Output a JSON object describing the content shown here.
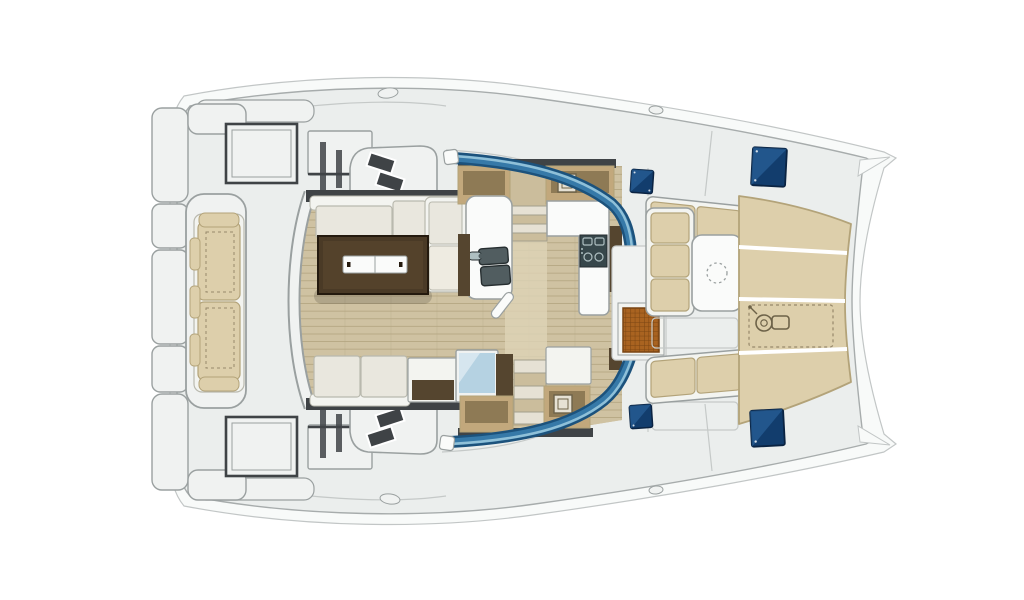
{
  "diagram": {
    "kind": "catamaran-deck-floor-plan",
    "view": "top-down",
    "text_labels": [],
    "parts": [
      "hull-deck",
      "bow-tips",
      "aft-platform",
      "aft-bench",
      "transom-step-panels",
      "deck-hatch-port",
      "deck-hatch-starboard",
      "side-deck-steps-port",
      "side-deck-steps-starboard",
      "saloon-floor",
      "saloon-sofa",
      "dining-table",
      "table-centerpiece",
      "galley-sink",
      "galley-stove",
      "galley-counter",
      "fridge-unit",
      "companionway-stairs-port",
      "companionway-stairs-starboard",
      "storage-lockers",
      "windshield-glass",
      "cockpit-settee",
      "cockpit-table",
      "cockpit-bench",
      "bow-sunpads",
      "windlass-locker",
      "teak-grate",
      "skylight-hatches",
      "cleats"
    ]
  },
  "icons": {
    "windlass-icon": "winch/gypsy glyph",
    "hatch-icon": "▣",
    "parasol-socket-icon": "◌ dashed circle",
    "stove-burner-icon": "○○",
    "sink-basin-icon": "▢▢"
  },
  "colors": {
    "page_bg": "#ffffff",
    "hull_outer": "#f8faf9",
    "hull_stroke": "#c2c6c6",
    "deck": "#ebeeed",
    "deck_stroke": "#a7acac",
    "seam": "#c5c9c8",
    "seam_dark": "#3f4346",
    "panel_fill": "#f0f2f1",
    "panel_stroke": "#9aa0a0",
    "panel_stroke_soft": "#c6cac9",
    "wood": "#cfc2a2",
    "wood_line": "#b3a581",
    "wood_light": "#ddd3b6",
    "wall_dark": "#3f4346",
    "wall_brown": "#55452f",
    "glass_dark": "#1c527c",
    "glass_mid": "#3679a8",
    "glass_light": "#8fc0d8",
    "navy": "#123d6d",
    "navy_light": "#2f6ba6",
    "navy_stroke": "#0a2342",
    "sofa_frame": "#f3f4f0",
    "cushion_white": "#e9e7de",
    "cushion_white2": "#eeebe1",
    "cushion_stroke": "#b9b9ae",
    "tan": "#ddcfab",
    "tan_stroke": "#b3a379",
    "tan_dash": "#97896b",
    "locker_tan": "#c2a87c",
    "locker_inner": "#8e7a55",
    "table_dark": "#4a3a26",
    "table_edge": "#241a0e",
    "table_mid": "#5d4930",
    "white": "#fafbfa",
    "steel": "#515d60",
    "steel_stroke": "#262e30",
    "teak": "#a96320",
    "teak_line": "#7a4512",
    "stair": "#e6e1d4",
    "stair_shadow": "#a39e8c",
    "landing": "#cbbd9c",
    "fridge_glass": "#b5d2e2",
    "icon_line": "#6d6248",
    "stove_dark": "#37474b",
    "stove_light": "#aebfc1",
    "shadow": "#000000"
  }
}
